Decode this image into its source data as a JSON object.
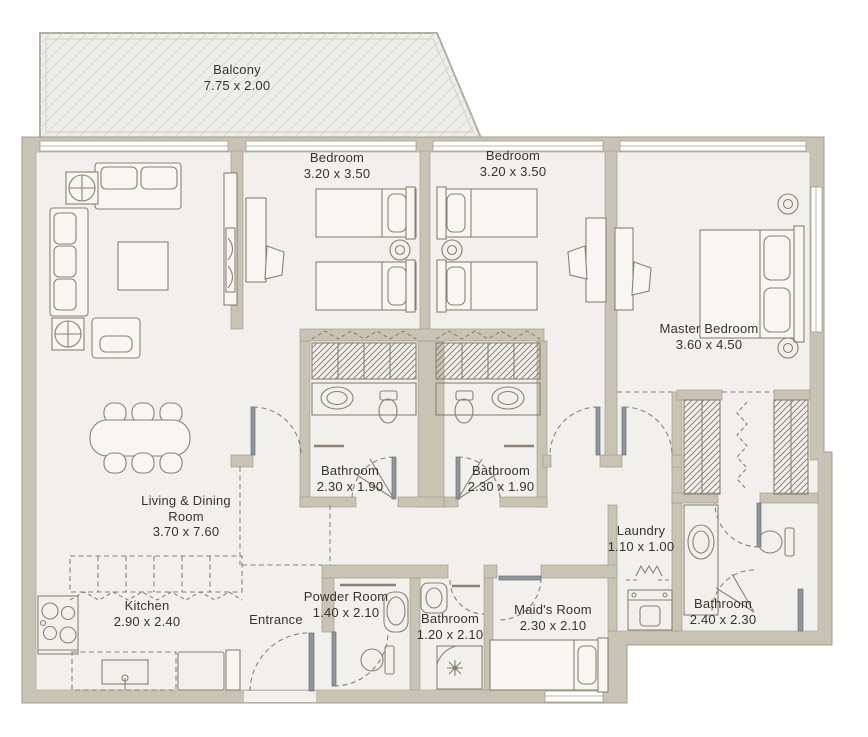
{
  "plan": {
    "rooms": [
      {
        "id": "balcony",
        "name": "Balcony",
        "dims": "7.75 x 2.00"
      },
      {
        "id": "bedroom-1",
        "name": "Bedroom",
        "dims": "3.20 x 3.50"
      },
      {
        "id": "bedroom-2",
        "name": "Bedroom",
        "dims": "3.20 x 3.50"
      },
      {
        "id": "master-bedroom",
        "name": "Master Bedroom",
        "dims": "3.60 x 4.50"
      },
      {
        "id": "bathroom-1",
        "name": "Bathroom",
        "dims": "2.30 x 1.90"
      },
      {
        "id": "bathroom-2",
        "name": "Bathroom",
        "dims": "2.30 x 1.90"
      },
      {
        "id": "living-dining",
        "name": "Living & Dining Room",
        "dims": "3.70 x 7.60"
      },
      {
        "id": "kitchen",
        "name": "Kitchen",
        "dims": "2.90 x 2.40"
      },
      {
        "id": "entrance",
        "name": "Entrance",
        "dims": ""
      },
      {
        "id": "powder-room",
        "name": "Powder Room",
        "dims": "1.40 x 2.10"
      },
      {
        "id": "bathroom-3",
        "name": "Bathroom",
        "dims": "1.20 x 2.10"
      },
      {
        "id": "maids-room",
        "name": "Maid's Room",
        "dims": "2.30 x 2.10"
      },
      {
        "id": "laundry",
        "name": "Laundry",
        "dims": "1.10 x 1.00"
      },
      {
        "id": "bathroom-4",
        "name": "Bathroom",
        "dims": "2.40 x 2.30"
      }
    ],
    "colors": {
      "wall": "#c8c3b4",
      "floor": "#f1f0ec",
      "balcony_floor": "#ededea",
      "furniture_line": "#8b8273",
      "door_leaf": "#8f959c",
      "text": "#35342f",
      "background": "#ffffff"
    }
  }
}
